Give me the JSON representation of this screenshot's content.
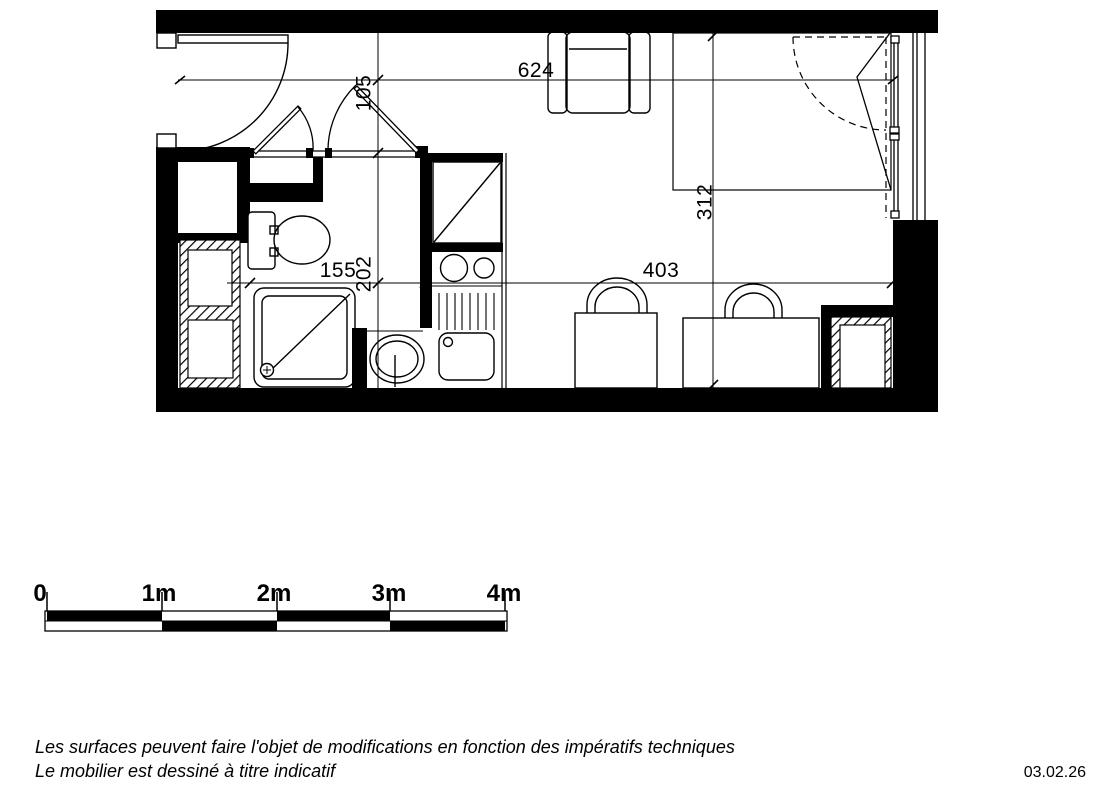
{
  "plan": {
    "dims": {
      "width": "624",
      "hall_depth": "105",
      "bath_depth": "202",
      "bath_width": "155",
      "room_depth": "312",
      "room_width": "403"
    },
    "scale_bar": {
      "labels": [
        "0",
        "1m",
        "2m",
        "3m",
        "4m"
      ]
    },
    "footer": {
      "line1": "Les surfaces peuvent faire l'objet de modifications en fonction des impératifs techniques",
      "line2": "Le mobilier est dessiné à titre indicatif",
      "date": "03.02.26"
    },
    "colors": {
      "ink": "#000000",
      "paper": "#ffffff"
    }
  }
}
